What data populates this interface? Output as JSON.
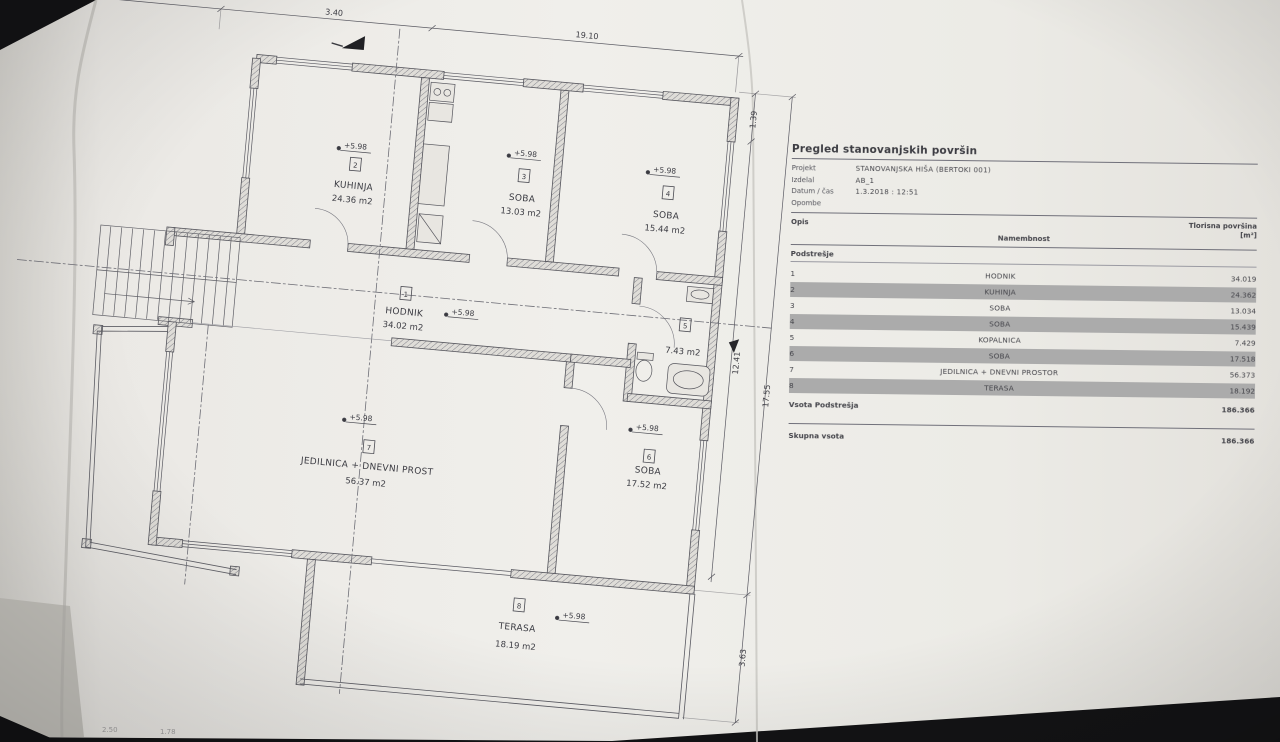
{
  "photo": {
    "description": "photograph of an architectural floor-plan sheet with room schedule",
    "paper_color": "#eceae6",
    "background_color": "#131315"
  },
  "plan": {
    "elevation_label": "+5.98",
    "top_dims": [
      "6.10",
      "3.40",
      "19.10"
    ],
    "right_dims": [
      "1.39",
      "12.41",
      "17.55",
      "3.63"
    ],
    "bottom_dims": [
      "2.50",
      "1.78"
    ],
    "rooms": [
      {
        "number": "1",
        "name": "HODNIK",
        "area": "34.02 m2"
      },
      {
        "number": "2",
        "name": "KUHINJA",
        "area": "24.36 m2"
      },
      {
        "number": "3",
        "name": "SOBA",
        "area": "13.03 m2"
      },
      {
        "number": "4",
        "name": "SOBA",
        "area": "15.44 m2"
      },
      {
        "number": "5",
        "name": "KOPALNICA",
        "area": "7.43 m2"
      },
      {
        "number": "6",
        "name": "SOBA",
        "area": "17.52 m2"
      },
      {
        "number": "7",
        "name": "JEDILNICA + DNEVNI PROST",
        "area": "56.37 m2"
      },
      {
        "number": "8",
        "name": "TERASA",
        "area": "18.19 m2"
      }
    ]
  },
  "schedule": {
    "title": "Pregled stanovanjskih površin",
    "meta": [
      {
        "label": "Projekt",
        "value": "STANOVANJSKA HIŠA (BERTOKI 001)"
      },
      {
        "label": "Izdelal",
        "value": "AB_1"
      },
      {
        "label": "Datum / čas",
        "value": "1.3.2018 : 12:51"
      },
      {
        "label": "Opombe",
        "value": ""
      }
    ],
    "columns": {
      "id": "Opis",
      "name": "Namembnost",
      "area_line1": "Tlorisna površina",
      "area_line2": "[m²]"
    },
    "section": "Podstrešje",
    "rows": [
      {
        "id": "1",
        "name": "HODNIK",
        "area": "34.019"
      },
      {
        "id": "2",
        "name": "KUHINJA",
        "area": "24.362"
      },
      {
        "id": "3",
        "name": "SOBA",
        "area": "13.034"
      },
      {
        "id": "4",
        "name": "SOBA",
        "area": "15.439"
      },
      {
        "id": "5",
        "name": "KOPALNICA",
        "area": "7.429"
      },
      {
        "id": "6",
        "name": "SOBA",
        "area": "17.518"
      },
      {
        "id": "7",
        "name": "JEDILNICA + DNEVNI PROSTOR",
        "area": "56.373"
      },
      {
        "id": "8",
        "name": "TERASA",
        "area": "18.192"
      }
    ],
    "sum_label": "Vsota Podstrešja",
    "sum_value": "186.366",
    "total_label": "Skupna vsota",
    "total_value": "186.366"
  }
}
